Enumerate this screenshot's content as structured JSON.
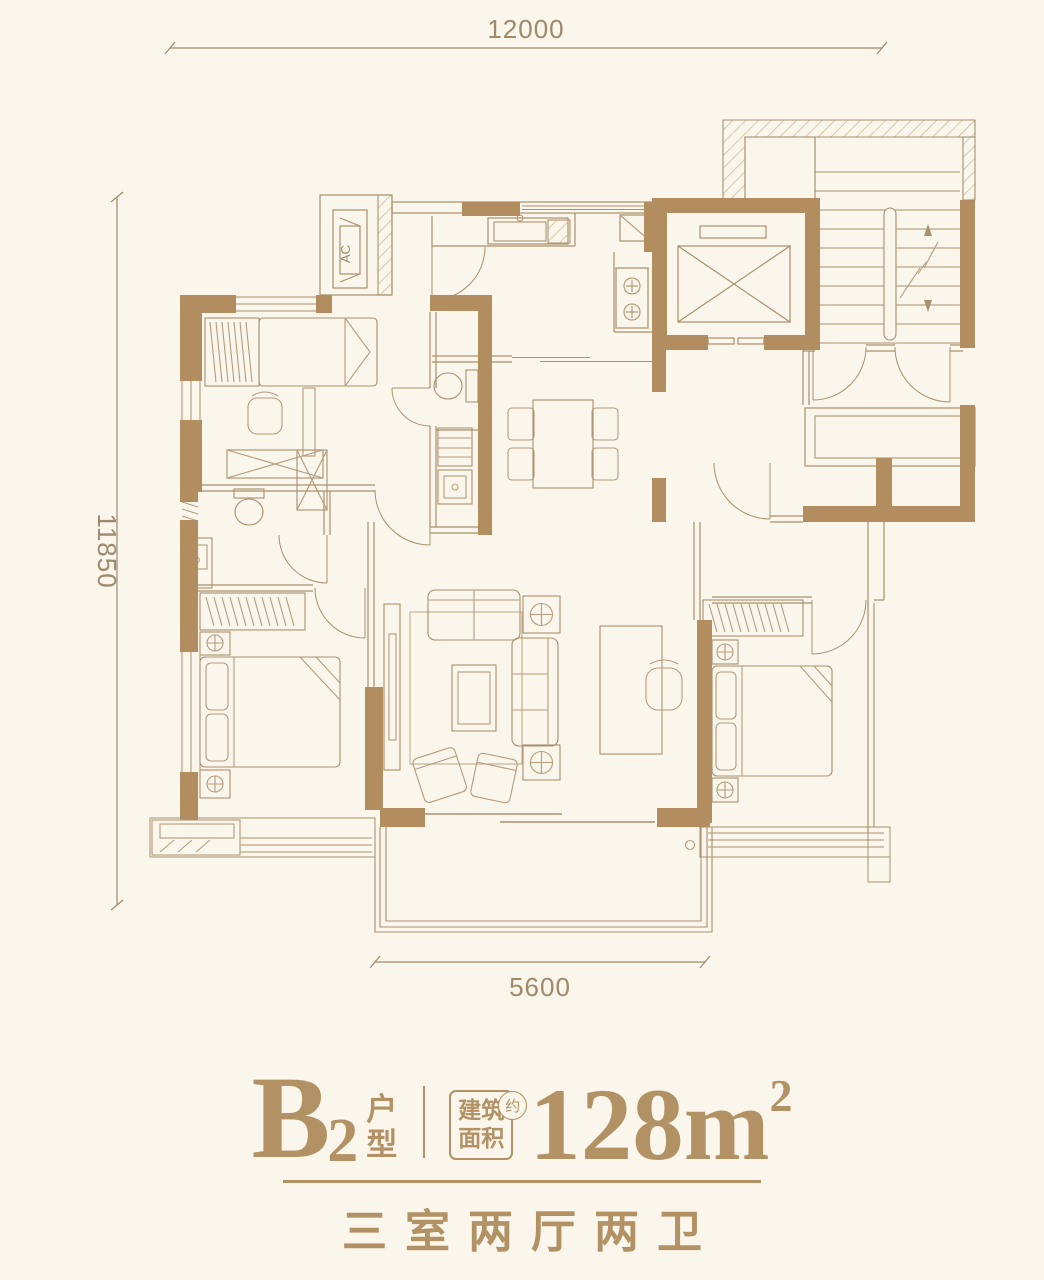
{
  "dimensions": {
    "top": "12000",
    "left": "11850",
    "bottom": "5600"
  },
  "plan_labels": {
    "ac_unit": "AC"
  },
  "footer": {
    "unit_letter": "B",
    "unit_number": "2",
    "unit_word_top": "户",
    "unit_word_bottom": "型",
    "area_label_top": "建筑",
    "area_label_bottom": "面积",
    "approx_char": "约",
    "area_value": "128m",
    "area_superscript": "2",
    "subtitle": "三室两厅两卫"
  },
  "colors": {
    "background": "#faf6ec",
    "wall": "#b28d5f",
    "structure_line": "#a8906c",
    "furniture_line": "#b59c7c",
    "text": "#a0896a",
    "accent": "#b29264"
  }
}
